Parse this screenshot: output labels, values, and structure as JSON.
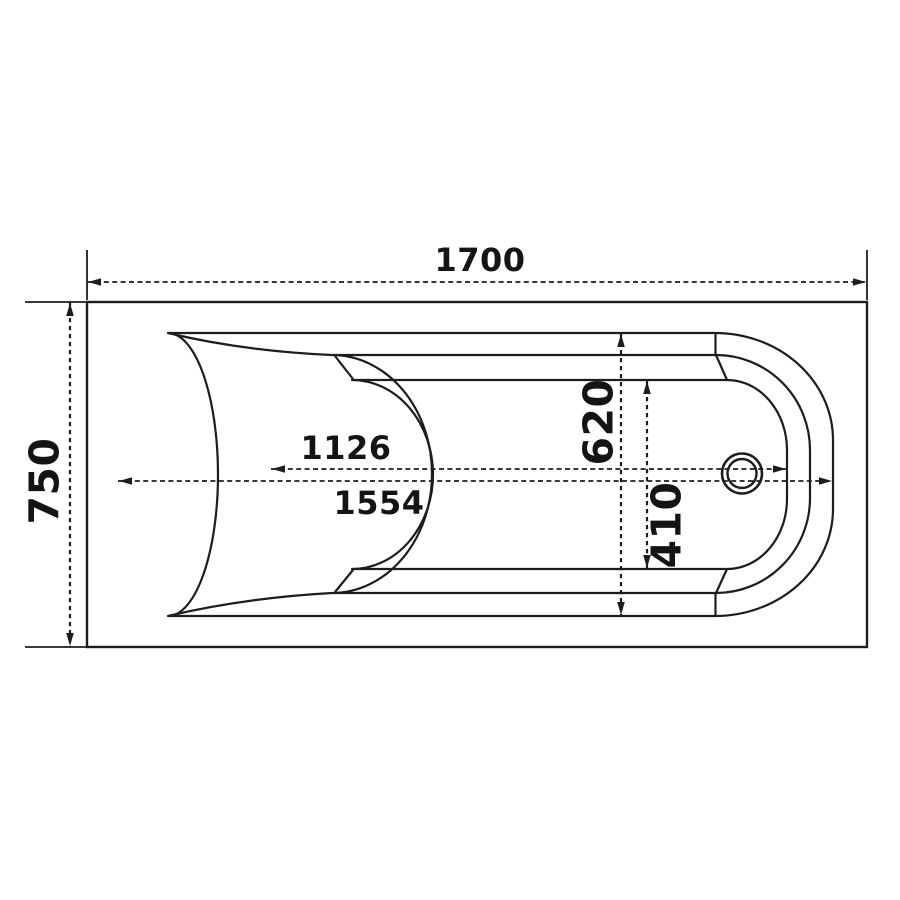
{
  "meta": {
    "type": "technical-drawing",
    "subject": "bathtub-top-view-dimensions",
    "units": "mm"
  },
  "labels": {
    "overall_length": "1700",
    "overall_width": "750",
    "rim_inner_length": "1554",
    "basin_length": "1126",
    "rim_width": "620",
    "basin_width": "410"
  },
  "dimensions_mm": {
    "overall_length": 1700,
    "overall_width": 750,
    "rim_inner_length": 1554,
    "basin_length": 1126,
    "rim_width": 620,
    "basin_width": 410
  },
  "colors": {
    "line": "#1d1d1d",
    "background": "#ffffff",
    "text": "#141414"
  }
}
